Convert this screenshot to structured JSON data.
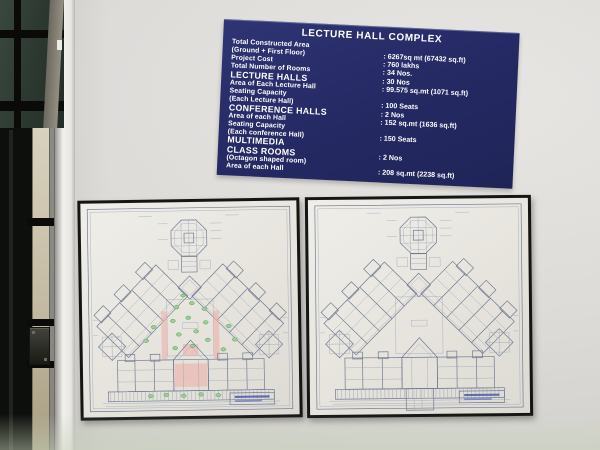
{
  "sign": {
    "title": "LECTURE HALL COMPLEX",
    "bg_color": "#242963",
    "text_color": "#ffffff",
    "rows": [
      {
        "l1": "Total Constructed Area",
        "l2": "(Ground + First Floor)",
        "value": ": 6267sq mt (67432 sq.ft)"
      },
      {
        "l1": "Project Cost",
        "value": ": 760 lakhs"
      },
      {
        "l1": "Total Number of Rooms",
        "value": ": 34 Nos."
      },
      {
        "l1": "LECTURE HALLS",
        "value": ": 30 Nos"
      },
      {
        "l1": "Area of Each Lecture Hall",
        "value": ": 99.575 sq.mt (1071 sq.ft)"
      },
      {
        "l1": "Seating Capacity",
        "l2": "(Each Lecture Hall)",
        "value": ": 100 Seats"
      },
      {
        "l1": "CONFERENCE HALLS",
        "value": ": 2 Nos"
      },
      {
        "l1": "Area of each Hall",
        "value": ": 152 sq.mt (1636 sq.ft)"
      },
      {
        "l1": "Seating Capacity",
        "l2": "(Each conference Hall)",
        "value": ": 150 Seats"
      },
      {
        "l1": "MULTIMEDIA",
        "l2": "CLASS ROOMS",
        "l3": "(Octagon shaped room)",
        "value": ": 2 Nos"
      },
      {
        "l1": "Area of each Hall",
        "value": ": 208 sq.mt (2238 sq.ft)"
      }
    ]
  },
  "plans": {
    "count": 2,
    "paper_color": "#e9e7e1",
    "ink_color": "#6f7890",
    "frame_color": "#151514",
    "left_plan_accent_green": "#9ccf97",
    "left_plan_accent_pink": "#eeb0aa",
    "title_block_text_color": "#4253a8"
  },
  "door": {
    "glass_color": "#2b372f",
    "frame_beige_color": "#c4bba3",
    "lock_color": "#26261f"
  },
  "wall": {
    "color": "#dddbd8",
    "bottom_tint": "#cdd8c4"
  }
}
